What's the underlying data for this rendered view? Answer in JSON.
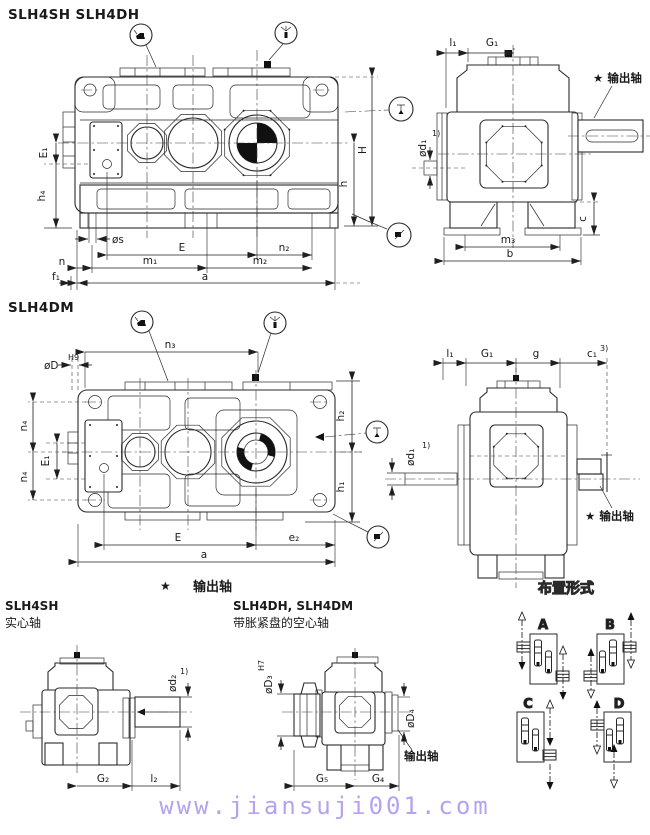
{
  "doc": {
    "title_top": "SLH4SH  SLH4DH",
    "title_middle": "SLH4DM",
    "footer_url": "www.jiansuji001.com",
    "colors": {
      "line": "#2a2a2a",
      "url_text": "#b5a3f0",
      "paper": "#ffffff",
      "black_fill": "#111111"
    }
  },
  "legend": {
    "star": "★",
    "output_shaft": "输出轴"
  },
  "view_side_sh_dh": {
    "dims": {
      "E1": "E₁",
      "h4": "h₄",
      "os": "øs",
      "n": "n",
      "f1": "f₁",
      "E": "E",
      "n2": "n₂",
      "m1": "m₁",
      "m2": "m₂",
      "a": "a",
      "H": "H",
      "h": "h"
    }
  },
  "view_end_sh_dh": {
    "dims": {
      "l1": "l₁",
      "G1": "G₁",
      "od1": "ød₁",
      "od1_note": "1)",
      "m3": "m₃",
      "b": "b",
      "c": "c"
    },
    "output_shaft_callout": "★ 输出轴"
  },
  "view_side_dm": {
    "dims": {
      "n3": "n₃",
      "oD": "øD",
      "oD_tol": "H9",
      "n4_top": "n₄",
      "E1": "E₁",
      "n4_bottom": "n₄",
      "E": "E",
      "e2": "e₂",
      "a": "a",
      "h2": "h₂",
      "h1": "h₁"
    }
  },
  "view_end_dm": {
    "dims": {
      "l1": "l₁",
      "G1": "G₁",
      "g": "g",
      "c1": "c₁",
      "c1_note": "3)",
      "od1": "ød₁",
      "od1_note": "1)"
    },
    "output_shaft_callout": "★ 输出轴"
  },
  "detail_solid": {
    "model": "SLH4SH",
    "shaft_type": "实心轴",
    "dims": {
      "od2": "ød₂",
      "od2_note": "1)",
      "G2": "G₂",
      "l2": "l₂"
    }
  },
  "detail_hollow": {
    "model": "SLH4DH, SLH4DM",
    "shaft_type": "带胀紧盘的空心轴",
    "dims": {
      "oD3": "øD₃",
      "oD3_tol": "H7",
      "oD4": "øD₄",
      "G5": "G₅",
      "G4": "G₄"
    },
    "output_shaft_label": "输出轴"
  },
  "arrangements": {
    "title": "布置形式",
    "items": [
      {
        "label": "A"
      },
      {
        "label": "B"
      },
      {
        "label": "C"
      },
      {
        "label": "D"
      }
    ]
  }
}
